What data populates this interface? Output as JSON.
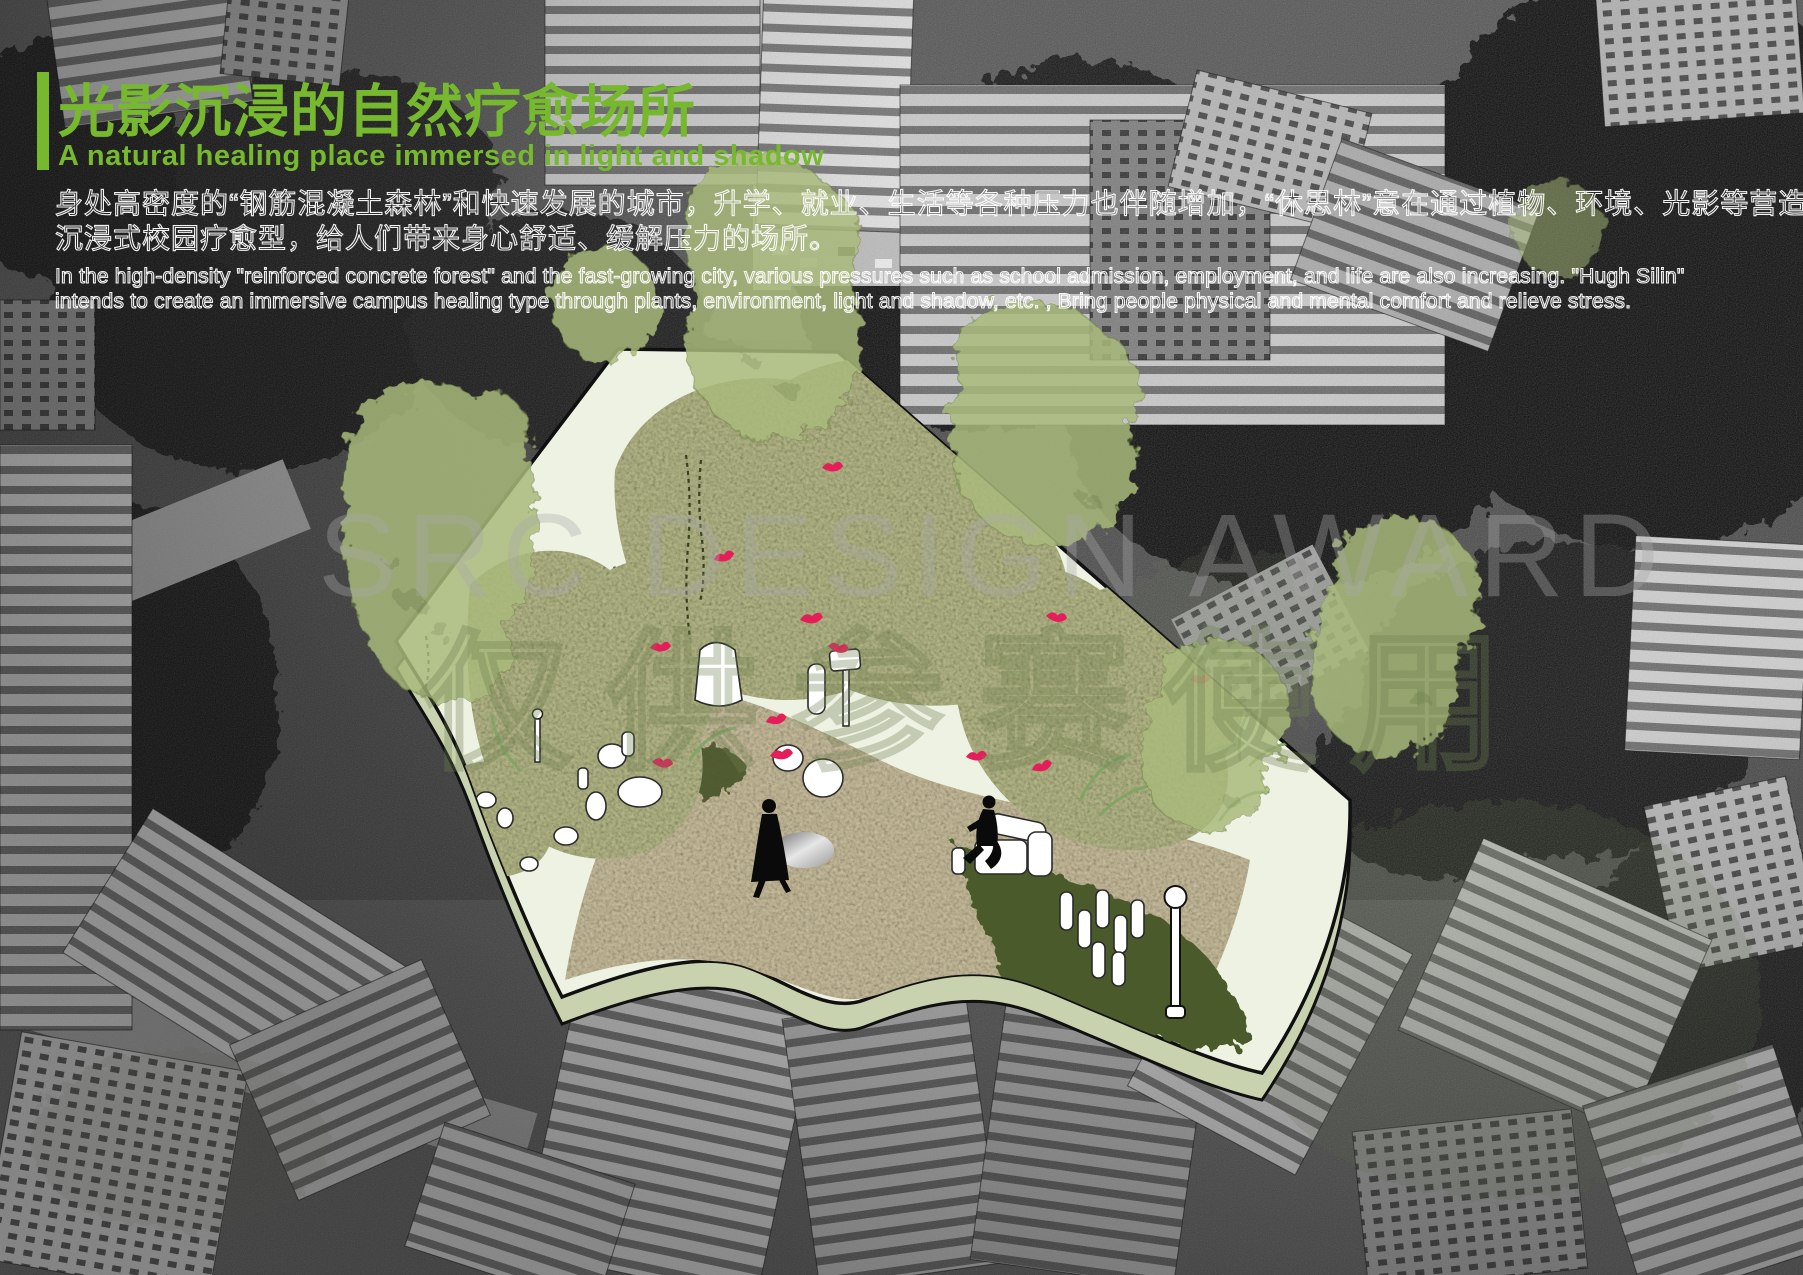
{
  "page": {
    "title_zh": "光影沉浸的自然疗愈场所",
    "subtitle_en": "A natural healing place immersed in light and shadow"
  },
  "intro": {
    "zh_lines": [
      "身处高密度的“钢筋混凝土森林”和快速发展的城市，升学、就业、生活等各种压力也伴随增加，“休思林”意在通过植物、环境、光影等营造",
      "沉浸式校园疗愈型，给人们带来身心舒适、缓解压力的场所。"
    ],
    "en_lines": [
      "In the high-density \"reinforced concrete forest\" and the fast-growing city, various pressures such as school admission, employment, and life are also increasing. \"Hugh Silin\"",
      "intends to create an immersive campus healing type through plants, environment, light and shadow, etc. , Bring people physical and mental comfort and relieve stress."
    ]
  },
  "watermark": {
    "line1": "SRC DESIGN AWARD",
    "line2": "仅供参赛使用"
  },
  "colors": {
    "accent_green": "#77B92E",
    "watercolor_green": "#A9BA7C",
    "platform_fill": "#EEF2E3",
    "platform_side": "#C9D2AF",
    "vegetation_base": "#B9BC8A",
    "path_sand": "#CDC2A0",
    "dark_lawn": "#4B5A2C",
    "bird_red": "#E51E5A",
    "figure_black": "#0A0A0A"
  },
  "illustration": {
    "elements": [
      "healing-garden-platform",
      "watercolor-tree-blobs",
      "planted-meadows",
      "sandy-path",
      "reflective-pond",
      "white-stones",
      "walking-figure",
      "seated-figure",
      "red-birds",
      "street-lamp",
      "hanging-vines"
    ]
  }
}
